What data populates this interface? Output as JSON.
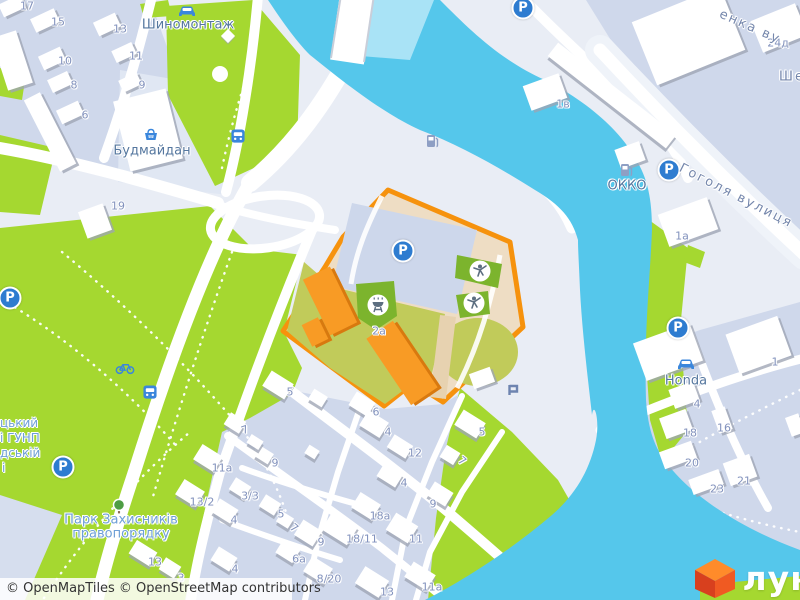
{
  "attribution": {
    "part1": "© OpenMapTiles",
    "part2": "© OpenStreetMap contributors"
  },
  "logo": {
    "text": "лун"
  },
  "colors": {
    "accent_orange": "#F6920D",
    "water": "#55C7EB",
    "park_green": "#A5D830",
    "playground_green": "#7CB42D",
    "icon_blue": "#2E7CD0",
    "logo_orange": "#F05A22"
  },
  "selected_plot": {
    "address_label": "2а"
  },
  "labels": [
    {
      "t": "17",
      "x": 27,
      "y": 6,
      "c": "h"
    },
    {
      "t": "15",
      "x": 58,
      "y": 22,
      "c": "h"
    },
    {
      "t": "13",
      "x": 120,
      "y": 29,
      "c": "h"
    },
    {
      "t": "11",
      "x": 136,
      "y": 56,
      "c": "h"
    },
    {
      "t": "10",
      "x": 65,
      "y": 61,
      "c": "h"
    },
    {
      "t": "9",
      "x": 142,
      "y": 85,
      "c": "h"
    },
    {
      "t": "8",
      "x": 74,
      "y": 85,
      "c": "h"
    },
    {
      "t": "6",
      "x": 85,
      "y": 115,
      "c": "h"
    },
    {
      "t": "19",
      "x": 118,
      "y": 206,
      "c": "h"
    },
    {
      "t": "24д",
      "x": 778,
      "y": 43,
      "c": "h"
    },
    {
      "t": "1в",
      "x": 563,
      "y": 104,
      "c": "h"
    },
    {
      "t": "1а",
      "x": 682,
      "y": 236,
      "c": "h"
    },
    {
      "t": "1",
      "x": 775,
      "y": 362,
      "c": "h"
    },
    {
      "t": "4",
      "x": 697,
      "y": 404,
      "c": "h"
    },
    {
      "t": "18",
      "x": 690,
      "y": 433,
      "c": "h"
    },
    {
      "t": "16",
      "x": 724,
      "y": 428,
      "c": "h"
    },
    {
      "t": "20",
      "x": 692,
      "y": 463,
      "c": "h"
    },
    {
      "t": "21",
      "x": 744,
      "y": 481,
      "c": "h"
    },
    {
      "t": "23",
      "x": 717,
      "y": 489,
      "c": "h"
    },
    {
      "t": "5",
      "x": 290,
      "y": 392,
      "c": "h"
    },
    {
      "t": "6",
      "x": 376,
      "y": 412,
      "c": "h"
    },
    {
      "t": "4",
      "x": 388,
      "y": 432,
      "c": "h"
    },
    {
      "t": "12",
      "x": 415,
      "y": 453,
      "c": "h"
    },
    {
      "t": "5",
      "x": 482,
      "y": 432,
      "c": "h"
    },
    {
      "t": "7",
      "x": 462,
      "y": 461,
      "c": "h",
      "r": 40
    },
    {
      "t": "4",
      "x": 404,
      "y": 483,
      "c": "h"
    },
    {
      "t": "9",
      "x": 433,
      "y": 504,
      "c": "h"
    },
    {
      "t": "18а",
      "x": 380,
      "y": 516,
      "c": "h"
    },
    {
      "t": "11",
      "x": 416,
      "y": 539,
      "c": "h"
    },
    {
      "t": "18/11",
      "x": 362,
      "y": 539,
      "c": "h"
    },
    {
      "t": "11а",
      "x": 432,
      "y": 587,
      "c": "h"
    },
    {
      "t": "13",
      "x": 387,
      "y": 592,
      "c": "h"
    },
    {
      "t": "8/20",
      "x": 329,
      "y": 579,
      "c": "h"
    },
    {
      "t": "6а",
      "x": 299,
      "y": 559,
      "c": "h"
    },
    {
      "t": "9",
      "x": 321,
      "y": 542,
      "c": "h"
    },
    {
      "t": "7",
      "x": 294,
      "y": 528,
      "c": "h",
      "r": 40
    },
    {
      "t": "5",
      "x": 281,
      "y": 514,
      "c": "h"
    },
    {
      "t": "4",
      "x": 234,
      "y": 520,
      "c": "h"
    },
    {
      "t": "3/3",
      "x": 250,
      "y": 496,
      "c": "h"
    },
    {
      "t": "13/2",
      "x": 202,
      "y": 502,
      "c": "h"
    },
    {
      "t": "4",
      "x": 235,
      "y": 569,
      "c": "h"
    },
    {
      "t": "3",
      "x": 181,
      "y": 578,
      "c": "h"
    },
    {
      "t": "11а",
      "x": 222,
      "y": 468,
      "c": "h"
    },
    {
      "t": "9",
      "x": 275,
      "y": 463,
      "c": "h"
    },
    {
      "t": "7",
      "x": 245,
      "y": 430,
      "c": "h",
      "r": -20
    },
    {
      "t": "13",
      "x": 155,
      "y": 562,
      "c": "h"
    },
    {
      "t": "2а",
      "x": 379,
      "y": 331,
      "c": "h"
    },
    {
      "t": "Шиномонтаж",
      "x": 188,
      "y": 25,
      "c": "p",
      "n": "poi-label-tire-service"
    },
    {
      "t": "Будмайдан",
      "x": 152,
      "y": 151,
      "c": "p",
      "n": "poi-label-budmaidan"
    },
    {
      "t": "ОККО",
      "x": 627,
      "y": 186,
      "c": "p",
      "n": "poi-label-okko"
    },
    {
      "t": "Honda",
      "x": 686,
      "y": 381,
      "c": "p",
      "n": "poi-label-honda"
    },
    {
      "t": "Гоголя вулиця",
      "x": 736,
      "y": 196,
      "c": "s",
      "r": 27,
      "n": "street-label-hoholia"
    },
    {
      "t": "енка ву",
      "x": 750,
      "y": 27,
      "c": "s",
      "r": 24,
      "n": "street-label-shevchenka-partial"
    },
    {
      "t": "Ше",
      "x": 792,
      "y": 77,
      "c": "s",
      "n": "street-label-fragment"
    },
    {
      "t": "Парк Захисників",
      "x": 121,
      "y": 520,
      "c": "k",
      "n": "park-label-line1"
    },
    {
      "t": "правопорядку",
      "x": 121,
      "y": 534,
      "c": "k",
      "n": "park-label-line2"
    },
    {
      "t": "цький",
      "x": 0,
      "y": 423,
      "c": "f"
    },
    {
      "t": "і ГУНП",
      "x": 0,
      "y": 438,
      "c": "f"
    },
    {
      "t": "дській",
      "x": 0,
      "y": 453,
      "c": "f"
    },
    {
      "t": "і",
      "x": 2,
      "y": 468,
      "c": "f"
    }
  ],
  "icons": [
    {
      "n": "parking",
      "x": 10,
      "y": 298,
      "g": "P"
    },
    {
      "n": "parking",
      "x": 63,
      "y": 467,
      "g": "P"
    },
    {
      "n": "parking",
      "x": 403,
      "y": 251,
      "g": "P"
    },
    {
      "n": "parking",
      "x": 523,
      "y": 8,
      "g": "P"
    },
    {
      "n": "parking",
      "x": 669,
      "y": 170,
      "g": "P"
    },
    {
      "n": "parking",
      "x": 678,
      "y": 328,
      "g": "P"
    },
    {
      "n": "bus",
      "x": 238,
      "y": 136
    },
    {
      "n": "bus",
      "x": 150,
      "y": 392
    },
    {
      "n": "bicycle",
      "x": 125,
      "y": 368
    },
    {
      "n": "car",
      "x": 187,
      "y": 11
    },
    {
      "n": "car",
      "x": 686,
      "y": 364
    },
    {
      "n": "fuel",
      "x": 432,
      "y": 141
    },
    {
      "n": "fuel",
      "x": 626,
      "y": 170
    },
    {
      "n": "tree",
      "x": 119,
      "y": 507
    },
    {
      "n": "fountain",
      "x": 220,
      "y": 74
    },
    {
      "n": "white-diamond",
      "x": 228,
      "y": 36
    },
    {
      "n": "playground",
      "x": 480,
      "y": 271
    },
    {
      "n": "playground",
      "x": 474,
      "y": 303
    },
    {
      "n": "grill",
      "x": 378,
      "y": 305
    },
    {
      "n": "monument",
      "x": 513,
      "y": 390
    },
    {
      "n": "basket",
      "x": 151,
      "y": 135
    }
  ]
}
